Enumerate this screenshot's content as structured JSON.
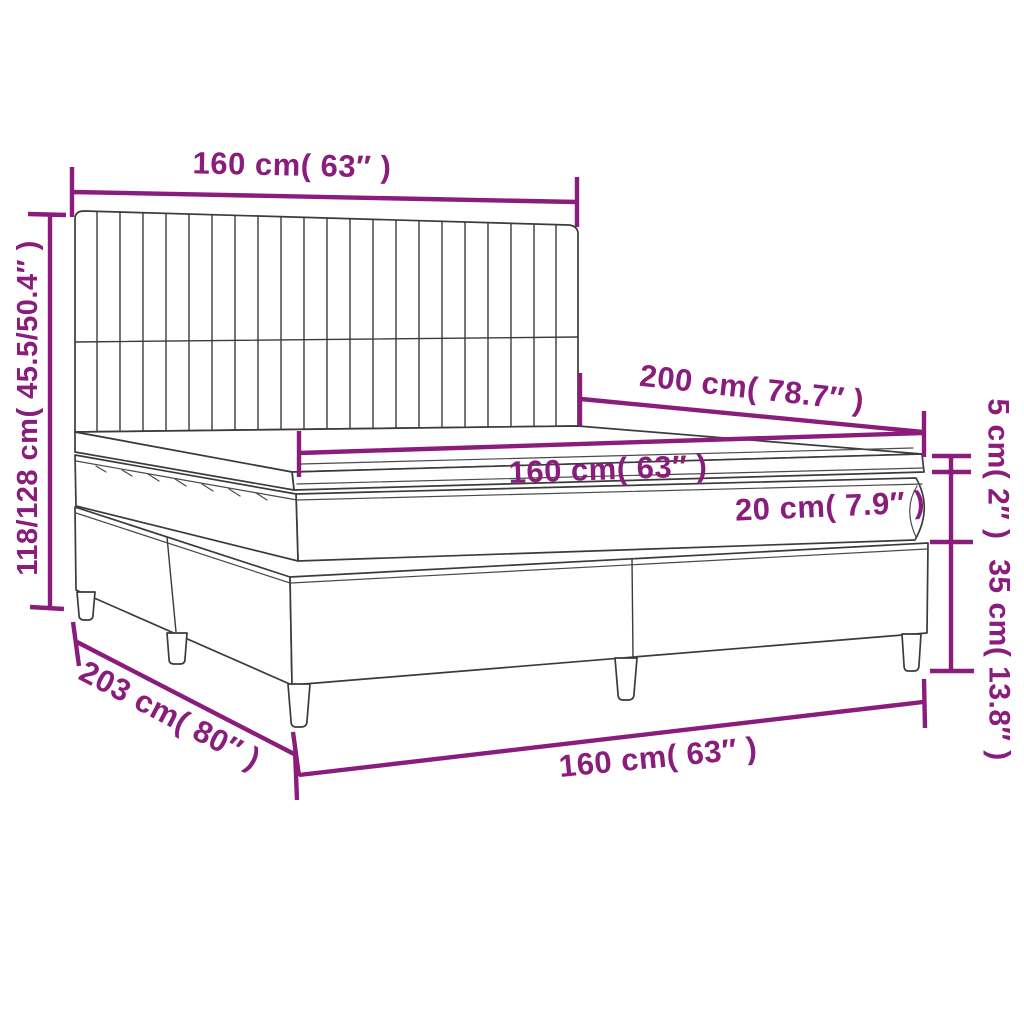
{
  "diagram_type": "furniture dimension diagram",
  "subject": "box spring bed with channel-tufted headboard, mattress and topper",
  "colors": {
    "dimension_annotation": "#8A1C7C",
    "bed_outline": "#3B3B3B",
    "background": "#FFFFFF"
  },
  "labels": {
    "headboard_width": "160 cm( 63″ )",
    "overall_height": "118/128 cm( 45.5/50.4″ )",
    "bed_length": "200 cm( 78.7″ )",
    "mattress_width": "160 cm( 63″ )",
    "mattress_height": "20 cm( 7.9″ )",
    "topper_height": "5 cm( 2″ )",
    "base_height": "35 cm( 13.8″ )",
    "overall_length": "203 cm( 80″ )",
    "base_width": "160 cm( 63″ )"
  },
  "measurements": {
    "headboard_width": {
      "cm": "160",
      "inches": "63"
    },
    "overall_height": {
      "cm": "118/128",
      "inches": "45.5/50.4"
    },
    "bed_length": {
      "cm": "200",
      "inches": "78.7"
    },
    "mattress_width": {
      "cm": "160",
      "inches": "63"
    },
    "mattress_height": {
      "cm": "20",
      "inches": "7.9"
    },
    "topper_height": {
      "cm": "5",
      "inches": "2"
    },
    "base_height": {
      "cm": "35",
      "inches": "13.8"
    },
    "overall_length": {
      "cm": "203",
      "inches": "80"
    },
    "base_width": {
      "cm": "160",
      "inches": "63"
    }
  }
}
